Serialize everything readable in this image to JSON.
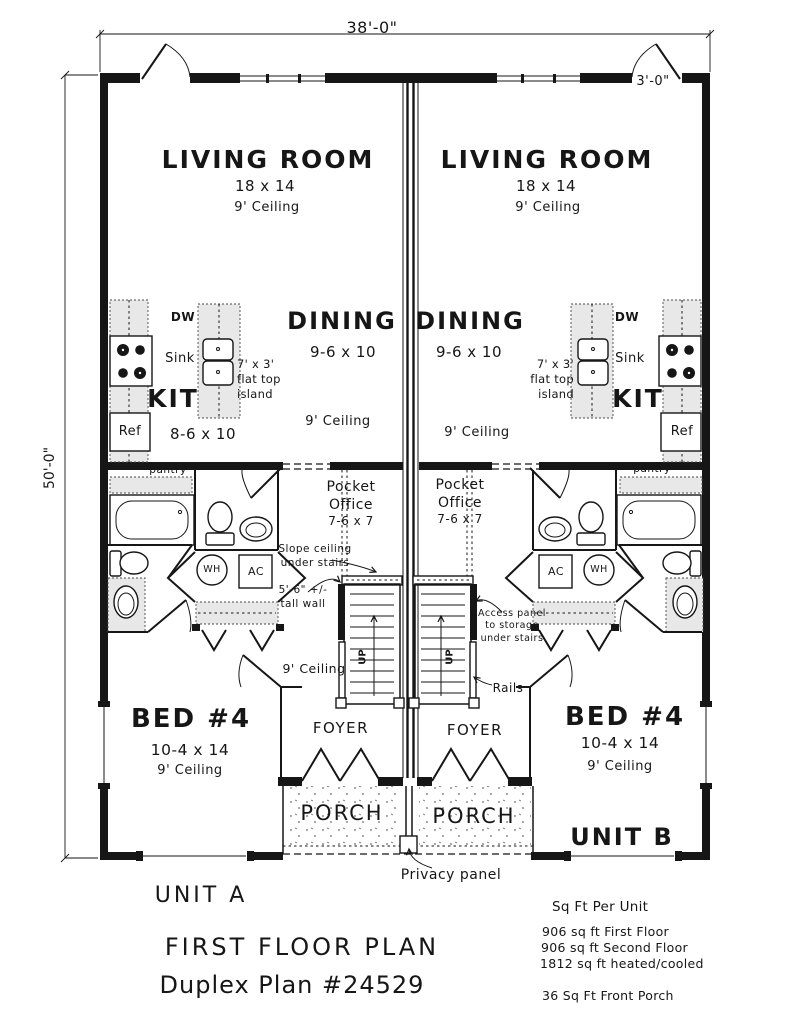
{
  "colors": {
    "line": "#161616",
    "shade": "#e8e8e8",
    "paper": "#ffffff"
  },
  "dimensions": {
    "overall_width": "38'-0\"",
    "overall_depth": "50'-0\"",
    "entry_offset": "3'-0\""
  },
  "unit_a": {
    "living_name": "LIVING ROOM",
    "living_size": "18 x 14",
    "living_ceiling": "9' Ceiling",
    "dining_name": "DINING",
    "dining_size": "9-6 x 10",
    "dining_ceiling": "9' Ceiling",
    "kitchen_name": "KIT",
    "kitchen_size": "8-6 x 10",
    "dw": "DW",
    "sink": "Sink",
    "ref": "Ref",
    "pantry": "pantry",
    "island_label": "7' x 3'\nflat top\nisland",
    "pocket_line1": "Pocket",
    "pocket_line2": "Office",
    "pocket_size": "7-6 x 7",
    "wh": "WH",
    "ac": "AC",
    "up": "UP",
    "hall_ceiling": "9' Ceiling",
    "foyer": "FOYER",
    "porch": "PORCH",
    "bed_name": "BED #4",
    "bed_size": "10-4 x 14",
    "bed_ceiling": "9' Ceiling"
  },
  "unit_b": {
    "living_name": "LIVING ROOM",
    "living_size": "18 x 14",
    "living_ceiling": "9' Ceiling",
    "dining_name": "DINING",
    "dining_size": "9-6 x 10",
    "dining_ceiling": "9' Ceiling",
    "kitchen_name": "KIT",
    "dw": "DW",
    "sink": "Sink",
    "ref": "Ref",
    "pantry": "pantry",
    "island_label": "7' x 3'\nflat top\nisland",
    "pocket_line1": "Pocket",
    "pocket_line2": "Office",
    "pocket_size": "7-6 x 7",
    "wh": "WH",
    "ac": "AC",
    "up": "UP",
    "foyer": "FOYER",
    "porch": "PORCH",
    "bed_name": "BED #4",
    "bed_size": "10-4 x 14",
    "bed_ceiling": "9' Ceiling",
    "unit_label": "UNIT B"
  },
  "annotations": {
    "slope_ceiling": "Slope ceiling\nunder stairs",
    "tall_wall": "5'-6\" +/-\ntall wall",
    "access_panel": "Access panel\nto storage\nunder stairs",
    "rails": "Rails",
    "privacy_panel": "Privacy panel"
  },
  "title_block": {
    "unit_a": "UNIT A",
    "plan_title": "FIRST FLOOR PLAN",
    "plan_number": "Duplex Plan #24529",
    "sqft_heading": "Sq Ft Per Unit",
    "sqft_first": "906 sq ft First Floor",
    "sqft_second": "906 sq ft Second Floor",
    "sqft_total": "1812 sq ft heated/cooled",
    "sqft_porch": "36 Sq Ft Front Porch"
  }
}
